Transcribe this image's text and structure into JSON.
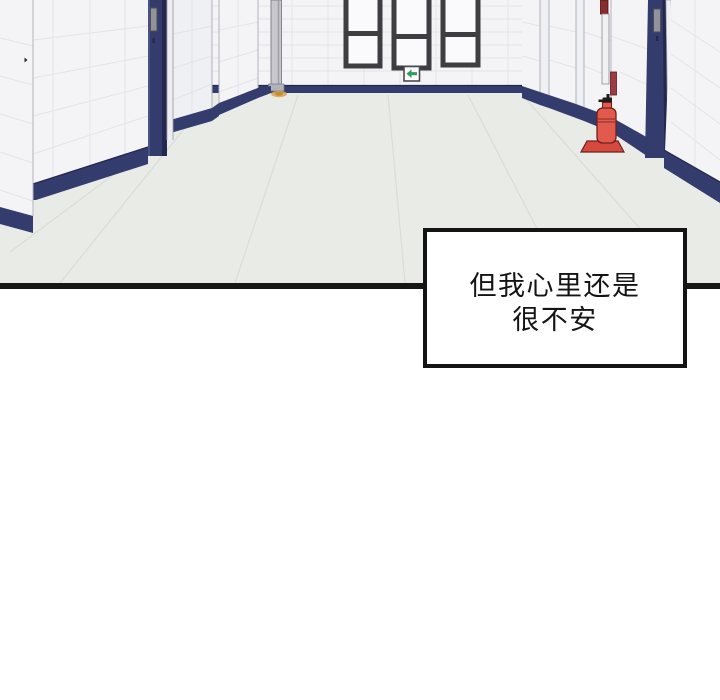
{
  "page": {
    "width": 720,
    "height": 700,
    "background": "#ffffff"
  },
  "panel": {
    "description": "Empty hallway drawn in perspective: white tiled walls, navy-blue baseboards and door frames with metal hinges, three narrow dark-framed windows on the far wall, a green exit sign with a left arrow, red signage strips and a red fire extinguisher on the right wall.",
    "border_color": "#161616"
  },
  "caption": {
    "lines": [
      "但我心里还是",
      "很不安"
    ],
    "text_color": "#141414",
    "background": "#ffffff",
    "border_color": "#141414"
  },
  "icons": [
    "exit-sign-left-arrow-icon",
    "fire-extinguisher-icon",
    "door-hinge-icon"
  ],
  "colors": {
    "wall": "#f4f4f7",
    "wall_dim": "#eff0f3",
    "floor": "#e9ece6",
    "floor_seam": "#d8dcd6",
    "tile_line": "#e0e1e6",
    "navy": "#343b6d",
    "navy_dark": "#23284e",
    "frame_dark": "#3d3d42",
    "glass": "#fafafc",
    "exit_green": "#2f9e62",
    "ext_red": "#e25a4e",
    "ext_red_dark": "#d6493f",
    "ext_outline": "#6e211c",
    "dark_red": "#8c2b2b",
    "maroon": "#9d3a42",
    "grey_post": "#c7c7cd",
    "hinge_grey": "#92929a",
    "amber": "#d9a64c",
    "ink": "#141414",
    "panel_border": "#161616",
    "edge_line": "#b2b2bb",
    "page_bg": "#ffffff"
  }
}
